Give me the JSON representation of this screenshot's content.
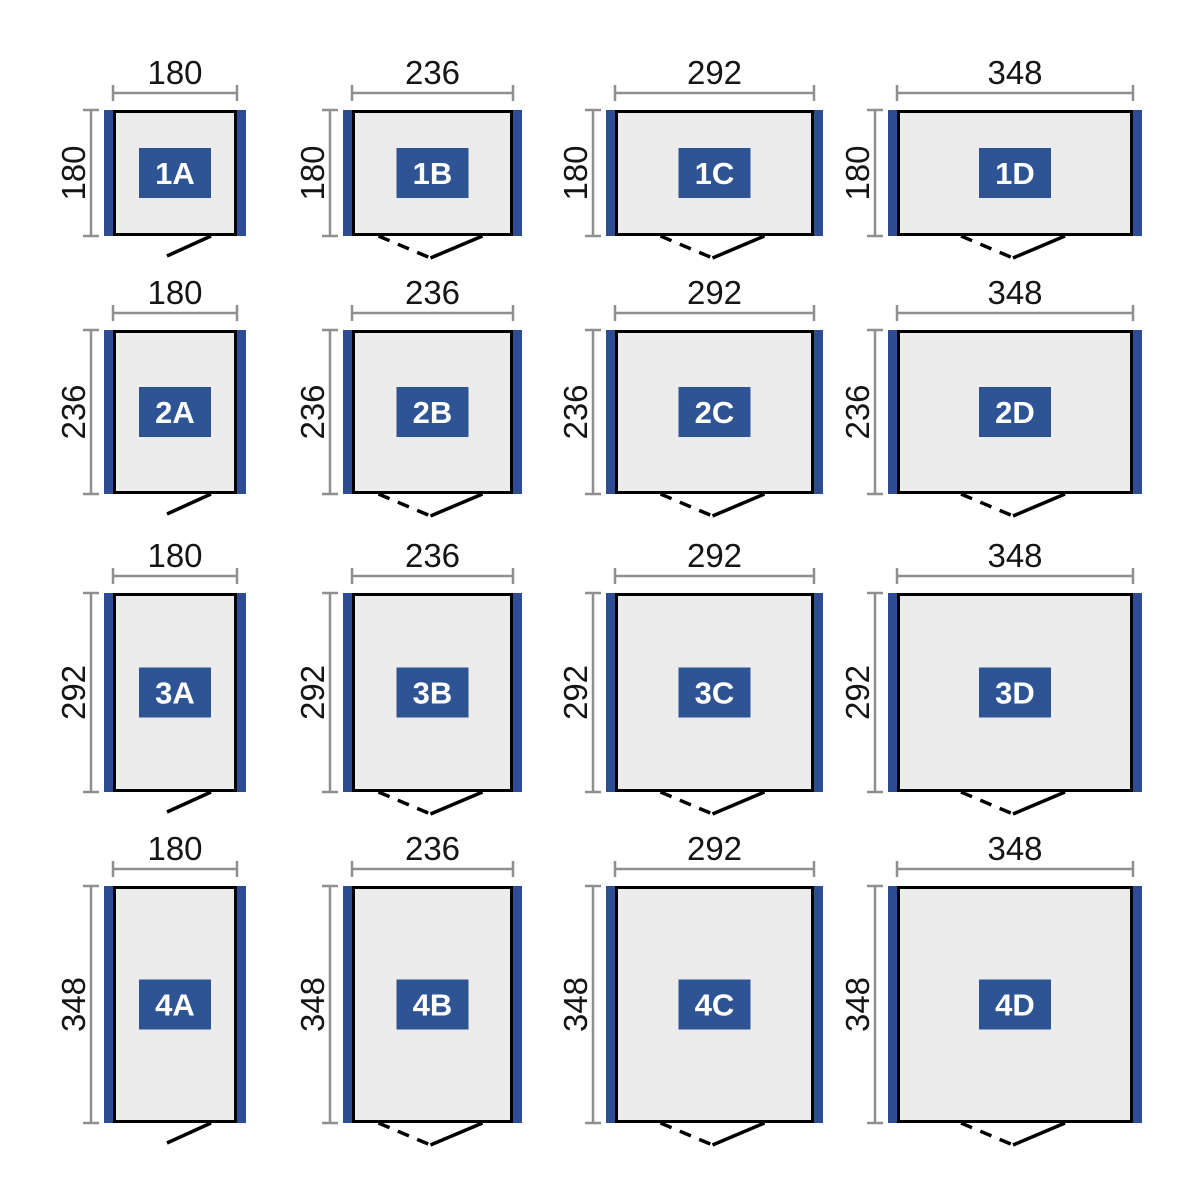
{
  "diagram": {
    "type": "floor-plan-size-matrix",
    "colors": {
      "background": "#ffffff",
      "plan_fill": "#ececec",
      "plan_border": "#000000",
      "side_panel_blue": "#2e4c93",
      "badge_blue": "#2f5494",
      "badge_text": "#ffffff",
      "dimension_line": "#8f8f8f",
      "dimension_text": "#151515",
      "door_line": "#000000"
    },
    "cells": [
      {
        "label": "1A",
        "width": "180",
        "height": "180",
        "door": "single"
      },
      {
        "label": "1B",
        "width": "236",
        "height": "180",
        "door": "double"
      },
      {
        "label": "1C",
        "width": "292",
        "height": "180",
        "door": "double"
      },
      {
        "label": "1D",
        "width": "348",
        "height": "180",
        "door": "double"
      },
      {
        "label": "2A",
        "width": "180",
        "height": "236",
        "door": "single"
      },
      {
        "label": "2B",
        "width": "236",
        "height": "236",
        "door": "double"
      },
      {
        "label": "2C",
        "width": "292",
        "height": "236",
        "door": "double"
      },
      {
        "label": "2D",
        "width": "348",
        "height": "236",
        "door": "double"
      },
      {
        "label": "3A",
        "width": "180",
        "height": "292",
        "door": "single"
      },
      {
        "label": "3B",
        "width": "236",
        "height": "292",
        "door": "double"
      },
      {
        "label": "3C",
        "width": "292",
        "height": "292",
        "door": "double"
      },
      {
        "label": "3D",
        "width": "348",
        "height": "292",
        "door": "double"
      },
      {
        "label": "4A",
        "width": "180",
        "height": "348",
        "door": "single"
      },
      {
        "label": "4B",
        "width": "236",
        "height": "348",
        "door": "double"
      },
      {
        "label": "4C",
        "width": "292",
        "height": "348",
        "door": "double"
      },
      {
        "label": "4D",
        "width": "348",
        "height": "348",
        "door": "double"
      }
    ]
  }
}
